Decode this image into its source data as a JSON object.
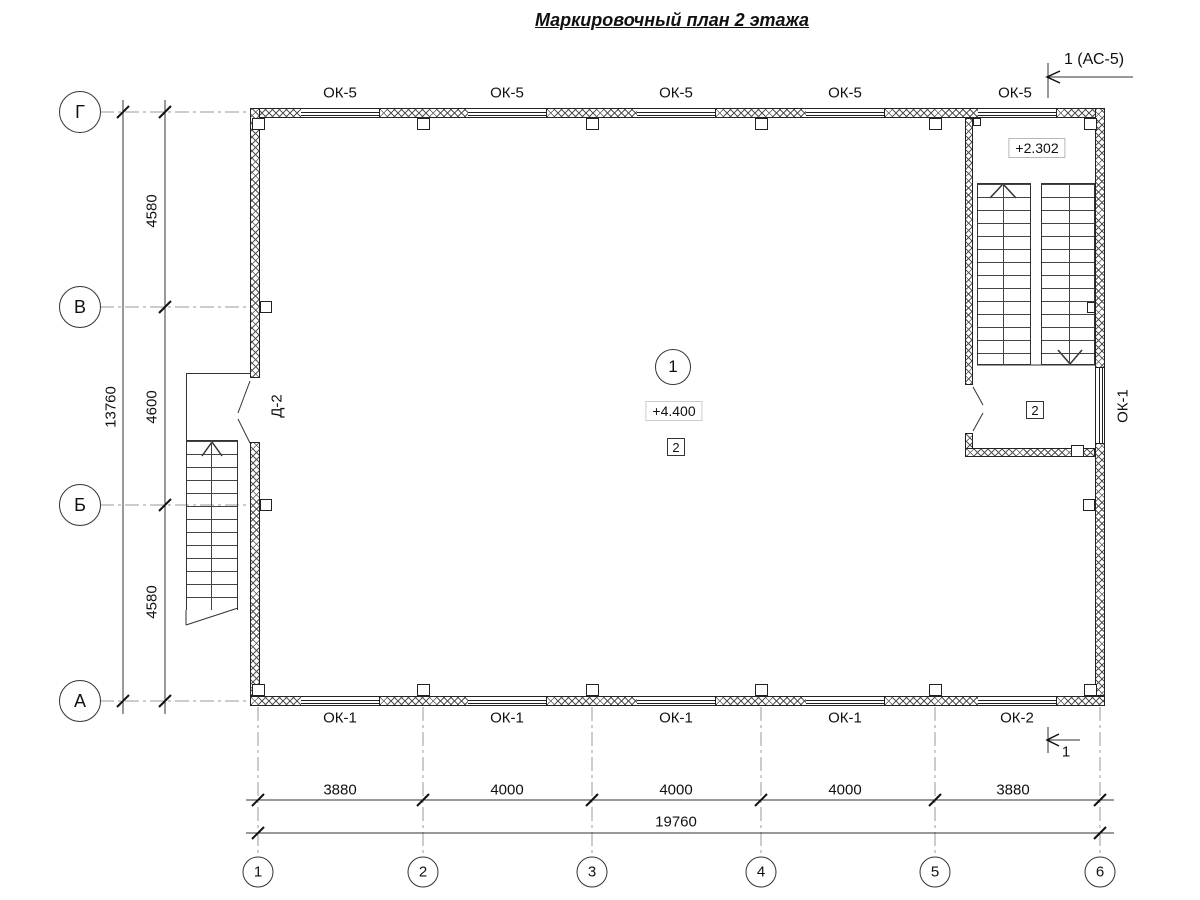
{
  "title": "Маркировочный план 2 этажа",
  "axes": {
    "rows": [
      {
        "label": "Г"
      },
      {
        "label": "В"
      },
      {
        "label": "Б"
      },
      {
        "label": "А"
      }
    ],
    "cols": [
      {
        "label": "1"
      },
      {
        "label": "2"
      },
      {
        "label": "3"
      },
      {
        "label": "4"
      },
      {
        "label": "5"
      },
      {
        "label": "6"
      }
    ]
  },
  "dimensions": {
    "left": {
      "segments": [
        "4580",
        "4600",
        "4580"
      ],
      "total": "13760"
    },
    "bottom": {
      "segments": [
        "3880",
        "4000",
        "4000",
        "4000",
        "3880"
      ],
      "total": "19760"
    }
  },
  "windows": {
    "top": [
      "ОК-5",
      "ОК-5",
      "ОК-5",
      "ОК-5",
      "ОК-5"
    ],
    "bottom": [
      "ОК-1",
      "ОК-1",
      "ОК-1",
      "ОК-1",
      "ОК-2"
    ],
    "right": "ОК-1"
  },
  "doors": {
    "left": "Д-2"
  },
  "levels": {
    "hall": "+4.400",
    "stair_landing": "+2.302"
  },
  "room_tags": {
    "hall_number": "1",
    "hall_finish": "2",
    "stair_room": "2"
  },
  "section_marks": {
    "top": "1 (АС-5)",
    "bottom": "1"
  },
  "colors": {
    "line": "#333333",
    "axis_line": "#999999",
    "hatch": "#555555"
  }
}
